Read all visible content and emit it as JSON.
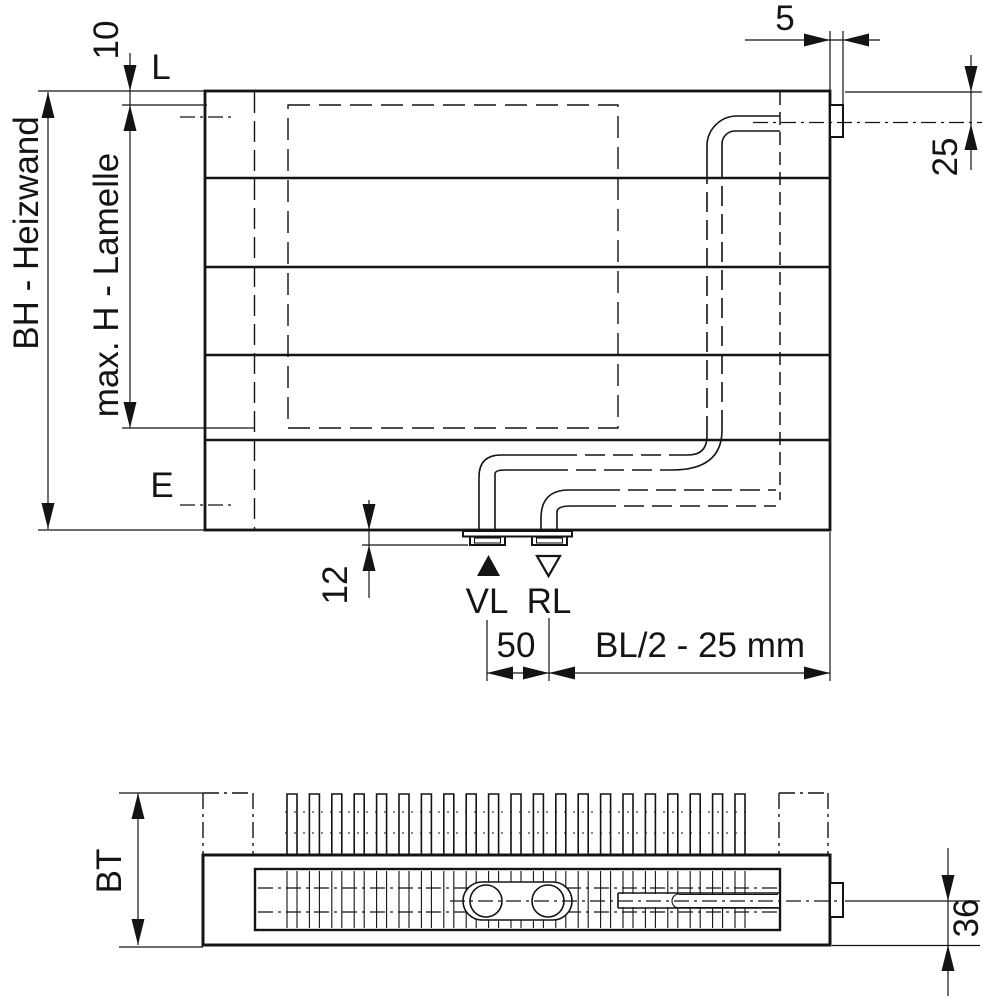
{
  "drawing": {
    "front_view": {
      "dim_top_offset": "10",
      "label_hanger_top": "L",
      "dim_connection_width": "5",
      "dim_connection_center": "25",
      "dim_height": "BH - Heizwand",
      "dim_lamella_max_height": "max. H - Lamelle",
      "label_hanger_bottom": "E",
      "dim_bottom_offset": "12",
      "label_supply": "VL",
      "label_return": "RL",
      "dim_connection_spacing": "50",
      "dim_connection_position": "BL/2 - 25 mm"
    },
    "top_view": {
      "dim_depth": "BT",
      "dim_pipe_axis_offset": "36"
    },
    "colors": {
      "line": "#141414",
      "background": "#ffffff"
    }
  }
}
